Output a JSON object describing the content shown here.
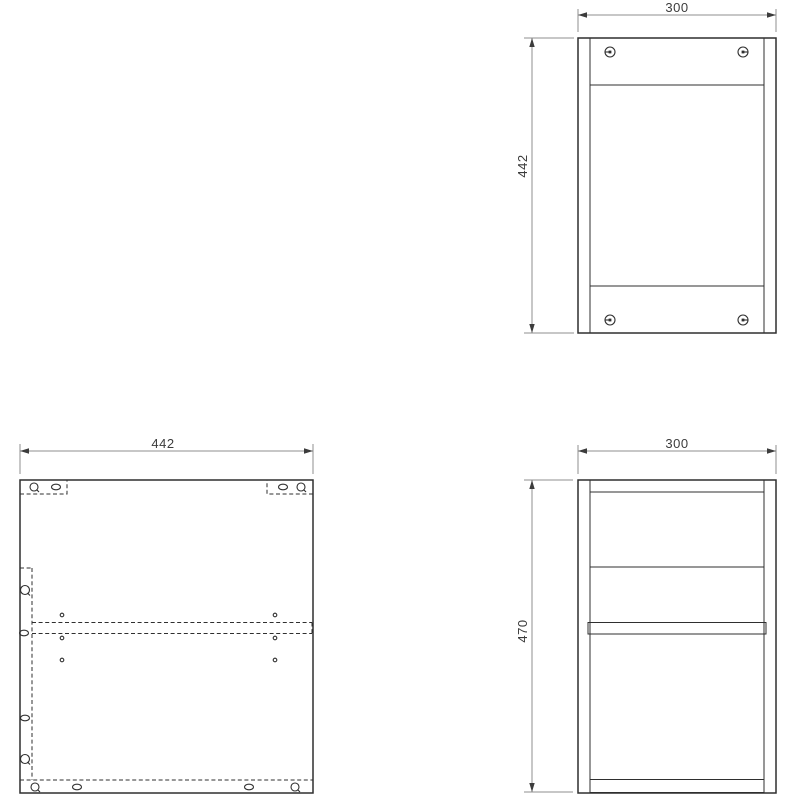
{
  "drawing": {
    "type": "furniture-assembly-technical-drawing",
    "background_color": "#ffffff",
    "line_color": "#2f2f2f",
    "dimension_line_color": "#8f8f8f",
    "text_color": "#3c3c3c",
    "views": {
      "front": {
        "name": "front-view",
        "width_dim": "300",
        "height_dim": "442",
        "fasteners": 4
      },
      "panel": {
        "name": "side-panel-drilling-view",
        "width_dim": "442"
      },
      "side": {
        "name": "side-section-view",
        "width_dim": "300",
        "height_dim": "470"
      }
    }
  }
}
